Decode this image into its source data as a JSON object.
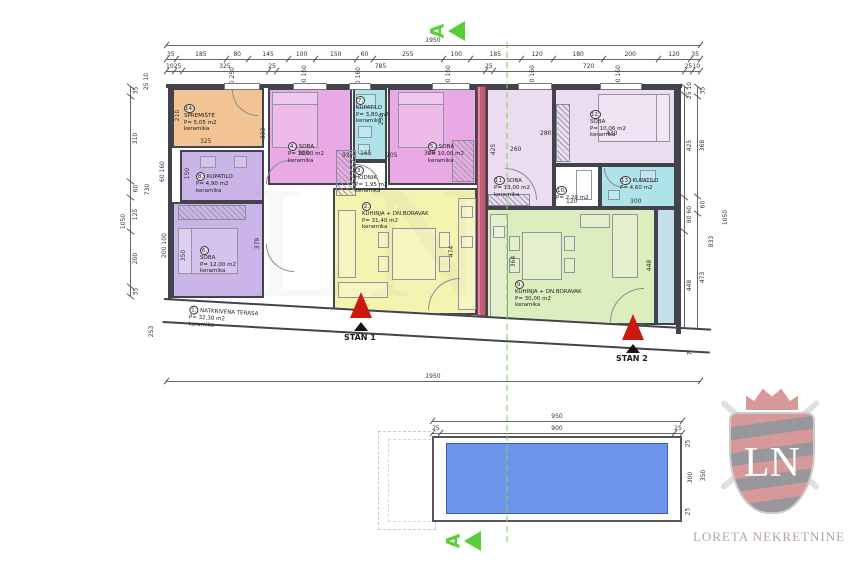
{
  "branding": {
    "agency": "LORETA NEKRETNINE",
    "initials": "LN"
  },
  "section": {
    "label": "A"
  },
  "stans": {
    "stan1": "STAN 1",
    "stan2": "STAN 2"
  },
  "rooms": [
    {
      "num": "1.",
      "name": "NATKRIVENA TERASA",
      "area": "P= 32,30 m2",
      "finish": "keramika"
    },
    {
      "num": "2.",
      "name": "KUHINJA + DN.BORAVAK",
      "area": "P= 31,40 m2",
      "finish": "keramika"
    },
    {
      "num": "3.",
      "name": "HODNIK",
      "area": "P= 1,95 m2",
      "finish": "keramika"
    },
    {
      "num": "4.",
      "name": "SOBA",
      "area": "P= 10,00 m2",
      "finish": "keramika"
    },
    {
      "num": "5.",
      "name": "SOBA",
      "area": "P= 10,00 m2",
      "finish": "keramika"
    },
    {
      "num": "6.",
      "name": "SOBA",
      "area": "P= 12,00 m2",
      "finish": "keramika"
    },
    {
      "num": "7.",
      "name": "KUPATILO",
      "area": "P= 3,80 m2",
      "finish": "keramika"
    },
    {
      "num": "8.",
      "name": "KUPATILO",
      "area": "P= 4,90 m2",
      "finish": "keramika"
    },
    {
      "num": "9.",
      "name": "KUHINJA + DN.BORAVAK",
      "area": "P= 30,00 m2",
      "finish": "keramika"
    },
    {
      "num": "10.",
      "name": "HODNIK",
      "area": "P= 2,20 m2",
      "finish": "keramika"
    },
    {
      "num": "11.",
      "name": "SOBA",
      "area": "P= 13,00 m2",
      "finish": "keramika"
    },
    {
      "num": "12.",
      "name": "SOBA",
      "area": "P= 10,06 m2",
      "finish": "keramika"
    },
    {
      "num": "13.",
      "name": "KUPATILO",
      "area": "P= 4,60 m2",
      "finish": "keramika"
    },
    {
      "num": "14.",
      "name": "SPREMIŠTE",
      "area": "P= 5,05 m2",
      "finish": "keramika"
    }
  ],
  "dims": {
    "top_total": "1950",
    "top_segments": [
      "35",
      "185",
      "80",
      "145",
      "100",
      "150",
      "60",
      "255",
      "100",
      "185",
      "120",
      "180",
      "200",
      "120",
      "35"
    ],
    "top_sub": [
      "10",
      "25",
      "325",
      "25",
      "785",
      "25",
      "720",
      "25",
      "10"
    ],
    "top_windows": [
      "80 250",
      "100 160",
      "60 160",
      "100 160",
      "120 160",
      "200 160"
    ],
    "bottom_total": "1950",
    "left_outer": "1050",
    "left_segments": [
      "35",
      "310",
      "60",
      "125",
      "200",
      "35"
    ],
    "left_mid": "730",
    "left_bottom": "253",
    "left_top_sub": "25 10",
    "left_windows": [
      "60 160",
      "200 100"
    ],
    "right_col1": [
      "25 10",
      "425",
      "80 60",
      "448"
    ],
    "right_col2": [
      "35",
      "368",
      "60",
      "473"
    ],
    "right_mid": "833",
    "right_outer": "1050",
    "right_bottom": "73",
    "terrace": [
      "58",
      "275",
      "75",
      "375",
      "50",
      "250",
      "1958",
      "200",
      "550",
      "125"
    ],
    "inline": {
      "v325": "325",
      "v210": "210",
      "v300": "300",
      "v333": "333",
      "v165": "165",
      "v230": "230",
      "v93": "93",
      "v205": "205",
      "v260": "260",
      "v425": "425",
      "v430": "430",
      "v280": "280",
      "v120": "120",
      "v150": "150",
      "v350": "350",
      "v379": "379",
      "v474": "474",
      "v448": "448",
      "v364": "364"
    }
  },
  "pool": {
    "top_total": "950",
    "side": "25",
    "top_inner": "900",
    "right_total": "350",
    "right_inner": "300"
  },
  "colors": {
    "storage_orange": "#f2c493",
    "bedroom_pink": "#e9a9e5",
    "bedroom_purple": "#cbb4e8",
    "bedroom_lavender": "#ecdcf0",
    "bath_cyan": "#aee3ea",
    "living_yellow": "#f5f3b0",
    "living_green": "#dcedbe",
    "divider_red": "#c25f79",
    "pool_blue": "#6d95e9",
    "section_green": "#59cf37",
    "marker_red": "#cf1712"
  }
}
